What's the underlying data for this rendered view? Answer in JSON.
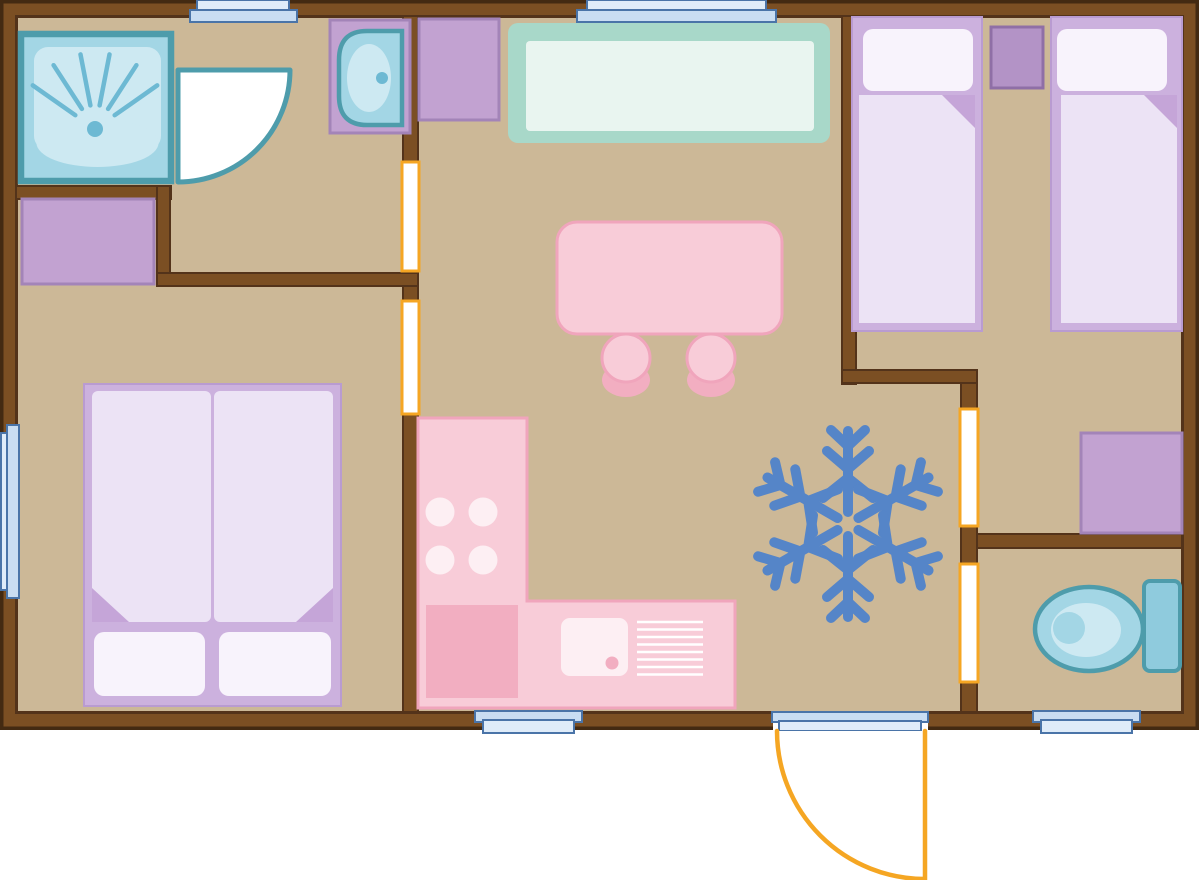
{
  "plan": {
    "type": "Mobile-home floor plan, top-down view",
    "rooms": [
      {
        "name": "bathroom",
        "items": [
          "shower cabin",
          "shower door swing",
          "washbasin on vanity"
        ]
      },
      {
        "name": "double bedroom",
        "items": [
          "double bed with 2 pillows",
          "wardrobe"
        ]
      },
      {
        "name": "living room with kitchen",
        "items": [
          "bench sofa",
          "dining table",
          "stool",
          "stool",
          "wardrobe",
          "L-shaped kitchen counter",
          "4-burner hob",
          "kitchen sink with drainer"
        ]
      },
      {
        "name": "twin bedroom",
        "items": [
          "single bed",
          "single bed",
          "nightstand",
          "wardrobe"
        ]
      },
      {
        "name": "wc",
        "items": [
          "toilet with cistern"
        ]
      }
    ],
    "openings": {
      "windows_top": 2,
      "windows_left": 1,
      "windows_bottom": 2,
      "interior_doorways": 4,
      "entry_door": "bottom wall, outward quarter swing with threshold"
    },
    "symbols": [
      {
        "name": "snowflake",
        "description": "blue six-armed snowflake symbol in living area"
      }
    ]
  },
  "colors": {
    "background": "#ffffff",
    "white": "#ffffff",
    "floor": "#ccb897",
    "wall_fill": "#7b4f23",
    "wall_outline": "#432a12",
    "wall_line": "#53331a",
    "teal_border": "#4e9cab",
    "teal_fill": "#a3d6e5",
    "teal_light": "#cde9f2",
    "teal_accent": "#6db9d3",
    "toilet_tank": "#8fcbdd",
    "mint_ring": "#a8d8c9",
    "mint_light": "#e9f5f0",
    "purple_fill": "#c2a2d1",
    "purple_border": "#a384b8",
    "purple_dark_fill": "#b393c6",
    "purple_dark_border": "#8f6fa6",
    "bed_frame": "#ccb1de",
    "bed_frame_border": "#b99bd1",
    "bed_duvet": "#ece3f5",
    "bed_pillow": "#f8f3fc",
    "bed_fold": "#c5a5d8",
    "pink_fill": "#f8ccd8",
    "pink_border": "#f0a5bc",
    "pink_dark": "#f2aec1",
    "pink_pale": "#fdeff3",
    "window_border": "#4a74a8",
    "window_fill": "#c9ddf2",
    "window_light": "#dfecf9",
    "door_orange": "#f5a623",
    "snowflake": "#5585c8"
  }
}
